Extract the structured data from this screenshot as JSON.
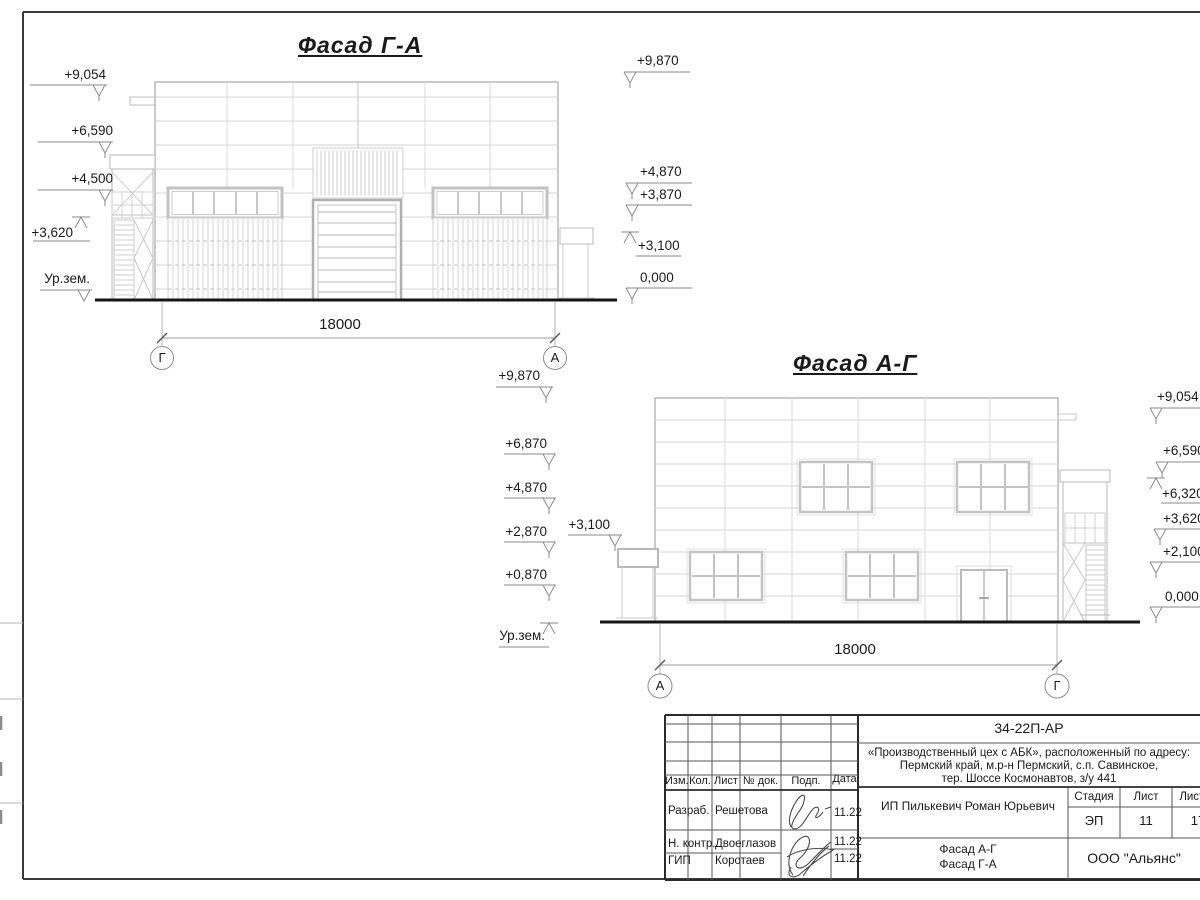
{
  "sheet": {
    "kind": "architectural facade elevation drawing",
    "colors": {
      "line_light": "#cfcfcf",
      "line_medium": "#b8b8b8",
      "ink": "#1a1a1a",
      "ground": "#151515"
    }
  },
  "drawing": {
    "facade1": {
      "title": "Фасад Г-А",
      "dimension": "18000",
      "axis_left": "Г",
      "axis_right": "А",
      "marks_left": [
        "+9,054",
        "+6,590",
        "+4,500",
        "+3,620",
        "Ур.зем."
      ],
      "marks_right": [
        "+9,870",
        "+4,870",
        "+3,870",
        "+3,100",
        "0,000"
      ]
    },
    "facade2": {
      "title": "Фасад А-Г",
      "dimension": "18000",
      "axis_left": "А",
      "axis_right": "Г",
      "marks_left": [
        "+9,870",
        "+6,870",
        "+4,870",
        "+2,870",
        "+0,870",
        "Ур.зем."
      ],
      "mark_canopy": "+3,100",
      "marks_right": [
        "+9,054",
        "+6,590",
        "+6,320",
        "+3,620",
        "+2,100",
        "0,000"
      ]
    }
  },
  "title_block": {
    "doc_number": "34-22П-АР",
    "project_line1": "«Производственный цех с АБК», расположенный по адресу:",
    "project_line2": "Пермский край, м.р-н Пермский, с.п. Савинское,",
    "project_line3": "тер. Шоссе Космонавтов, з/у 441",
    "columns": {
      "izm": "Изм.",
      "kol": "Кол.",
      "list": "Лист",
      "doc": "№ док.",
      "podp": "Подп.",
      "data": "Дата"
    },
    "rows": [
      {
        "role": "Разраб.",
        "name": "Решетова",
        "date": "11.22"
      },
      {
        "role": "Н. контр.",
        "name": "Двоеглазов",
        "date": "11.22"
      },
      {
        "role": "ГИП",
        "name": "Коротаев",
        "date": "11.22"
      }
    ],
    "client": "ИП Пилькевич Роман Юрьевич",
    "stage_label": "Стадия",
    "sheet_label": "Лист",
    "sheets_label": "Листов",
    "stage": "ЭП",
    "sheet": "11",
    "sheets": "17",
    "sheet_title_line1": "Фасад А-Г",
    "sheet_title_line2": "Фасад Г-А",
    "company": "ООО \"Альянс\""
  }
}
